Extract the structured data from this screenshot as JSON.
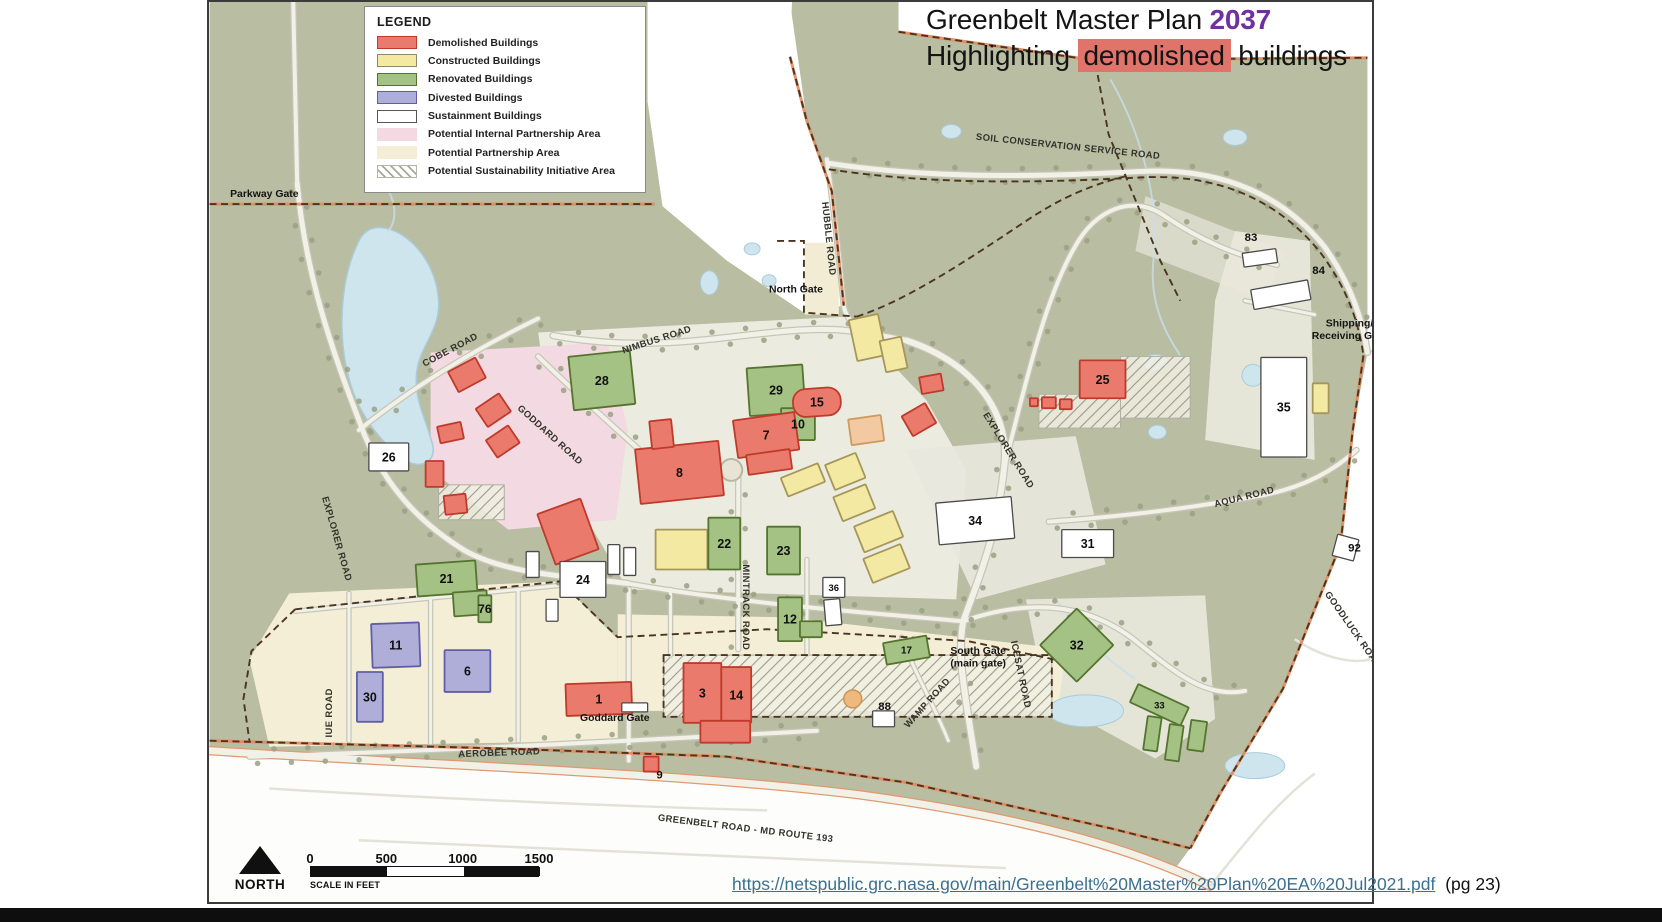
{
  "title": {
    "line1_prefix": "Greenbelt Master Plan ",
    "line1_year": "2037",
    "line2_prefix": "Highlighting ",
    "line2_highlight": "demolished",
    "line2_suffix": " buildings"
  },
  "legend": {
    "title": "LEGEND",
    "items": [
      {
        "label": "Demolished Buildings",
        "fill": "#ea7a6c",
        "stroke": "#c03a2b",
        "pattern": "solid"
      },
      {
        "label": "Constructed Buildings",
        "fill": "#f3e9a2",
        "stroke": "#8b8b6a",
        "pattern": "solid"
      },
      {
        "label": "Renovated Buildings",
        "fill": "#a3c283",
        "stroke": "#55742f",
        "pattern": "solid"
      },
      {
        "label": "Divested Buildings",
        "fill": "#afaed8",
        "stroke": "#605ea8",
        "pattern": "solid"
      },
      {
        "label": "Sustainment Buildings",
        "fill": "#ffffff",
        "stroke": "#555555",
        "pattern": "solid"
      },
      {
        "label": "Potential Internal Partnership Area",
        "fill": "#f3d9e1",
        "stroke": "none",
        "pattern": "solid"
      },
      {
        "label": "Potential Partnership Area",
        "fill": "#f5eed6",
        "stroke": "none",
        "pattern": "solid"
      },
      {
        "label": "Potential Sustainability Initiative Area",
        "fill": "",
        "stroke": "none",
        "pattern": "hatch"
      }
    ]
  },
  "scalebar": {
    "ticks": [
      "0",
      "500",
      "1000",
      "1500"
    ],
    "caption": "SCALE IN FEET",
    "north_label": "NORTH"
  },
  "footer": {
    "url": "https://netspublic.grc.nasa.gov/main/Greenbelt%20Master%20Plan%20EA%20Jul2021.pdf",
    "page_ref": "(pg 23)"
  },
  "colors": {
    "accent_year": "#7030a0",
    "highlight": "#e1746a",
    "link": "#3a7191",
    "terrain": "#b9bda1",
    "terrain_light": "#eeede4",
    "water": "#cfe5ee",
    "water_stroke": "#a9cbda",
    "pink_area": "#f3d9e1",
    "cream_area": "#f5eed6",
    "demolished": "#ea7a6c",
    "demolished_stroke": "#c03a2b",
    "constructed": "#f3e9a2",
    "constructed_stroke": "#a5975a",
    "renovated": "#a3c283",
    "renovated_stroke": "#55742f",
    "divested": "#afaed8",
    "divested_stroke": "#605ea8",
    "sustainment": "#ffffff",
    "sustainment_stroke": "#4a4a4a",
    "partnership_orange": "#f2c9a0",
    "partnership_orange_stroke": "#cf9a60",
    "boundary_black": "#4a3520",
    "boundary_orange": "#e08a5e",
    "road_fill": "#f2f1e8",
    "road_casing": "#c6c6b8",
    "greenbelt_road_casing": "#e09a70",
    "tree": "#9aa184"
  },
  "map": {
    "road_labels": [
      {
        "text": "COBE ROAD",
        "x": 243,
        "y": 352,
        "r": -28
      },
      {
        "text": "GODDARD ROAD",
        "x": 340,
        "y": 437,
        "r": 42
      },
      {
        "text": "NIMBUS ROAD",
        "x": 450,
        "y": 342,
        "r": -18
      },
      {
        "text": "EXPLORER ROAD",
        "x": 125,
        "y": 540,
        "r": 74
      },
      {
        "text": "EXPLORER ROAD",
        "x": 800,
        "y": 452,
        "r": 58
      },
      {
        "text": "MINTRACK ROAD",
        "x": 536,
        "y": 608,
        "r": 90
      },
      {
        "text": "IUE ROAD",
        "x": 123,
        "y": 714,
        "r": -90
      },
      {
        "text": "AEROBEE ROAD",
        "x": 291,
        "y": 757,
        "r": -2
      },
      {
        "text": "WAMP ROAD",
        "x": 723,
        "y": 706,
        "r": -48
      },
      {
        "text": "GREENBELT ROAD - MD ROUTE 193",
        "x": 538,
        "y": 833,
        "r": 7
      },
      {
        "text": "SOIL CONSERVATION SERVICE ROAD",
        "x": 862,
        "y": 148,
        "r": 6
      },
      {
        "text": "AQUA ROAD",
        "x": 1040,
        "y": 500,
        "r": -14
      },
      {
        "text": "GOODLUCK ROAD",
        "x": 1146,
        "y": 632,
        "r": 55
      },
      {
        "text": "HUBBLE ROAD",
        "x": 619,
        "y": 238,
        "r": 84
      },
      {
        "text": "ICESAT ROAD",
        "x": 812,
        "y": 676,
        "r": 78
      }
    ],
    "gate_labels": [
      {
        "lines": [
          "Parkway Gate"
        ],
        "x": 55,
        "y": 196
      },
      {
        "lines": [
          "North Gate"
        ],
        "x": 589,
        "y": 292
      },
      {
        "lines": [
          "Shipping/",
          "Receiving Gate"
        ],
        "x": 1145,
        "y": 326
      },
      {
        "lines": [
          "South Gate",
          "(main gate)"
        ],
        "x": 772,
        "y": 655
      },
      {
        "lines": [
          "Goddard Gate"
        ],
        "x": 407,
        "y": 722
      }
    ],
    "number_labels": [
      {
        "text": "83",
        "x": 1046,
        "y": 236
      },
      {
        "text": "84",
        "x": 1114,
        "y": 269
      },
      {
        "text": "88",
        "x": 678,
        "y": 707
      },
      {
        "text": "9",
        "x": 452,
        "y": 776
      },
      {
        "text": "92",
        "x": 1150,
        "y": 548
      }
    ],
    "buildings": [
      {
        "n": "26",
        "t": "s",
        "x": 160,
        "y": 443,
        "w": 40,
        "h": 28,
        "r": 0
      },
      {
        "n": "28",
        "t": "r",
        "x": 363,
        "y": 353,
        "w": 62,
        "h": 54,
        "r": -6
      },
      {
        "n": "29",
        "t": "r",
        "x": 541,
        "y": 366,
        "w": 56,
        "h": 48,
        "r": -4
      },
      {
        "n": "10",
        "t": "r",
        "x": 574,
        "y": 408,
        "w": 34,
        "h": 32,
        "r": 0
      },
      {
        "n": "7",
        "t": "d",
        "x": 528,
        "y": 416,
        "w": 62,
        "h": 38,
        "r": -8
      },
      {
        "n": "",
        "t": "d",
        "x": 540,
        "y": 452,
        "w": 44,
        "h": 20,
        "r": -8
      },
      {
        "n": "8",
        "t": "d",
        "x": 430,
        "y": 445,
        "w": 84,
        "h": 55,
        "r": -6
      },
      {
        "n": "",
        "t": "d",
        "x": 443,
        "y": 420,
        "w": 22,
        "h": 28,
        "r": -6
      },
      {
        "n": "",
        "t": "d",
        "x": 337,
        "y": 505,
        "w": 46,
        "h": 54,
        "r": -20
      },
      {
        "n": "15",
        "t": "d",
        "x": 586,
        "y": 388,
        "w": 48,
        "h": 28,
        "r": -4,
        "blob": true
      },
      {
        "n": "",
        "t": "d",
        "x": 714,
        "y": 375,
        "w": 22,
        "h": 17,
        "r": -10
      },
      {
        "n": "",
        "t": "d",
        "x": 699,
        "y": 408,
        "w": 27,
        "h": 23,
        "r": -30
      },
      {
        "n": "",
        "t": "d",
        "x": 243,
        "y": 363,
        "w": 31,
        "h": 23,
        "r": -28
      },
      {
        "n": "",
        "t": "d",
        "x": 271,
        "y": 399,
        "w": 28,
        "h": 22,
        "r": -34
      },
      {
        "n": "",
        "t": "d",
        "x": 230,
        "y": 424,
        "w": 24,
        "h": 17,
        "r": -12
      },
      {
        "n": "",
        "t": "d",
        "x": 281,
        "y": 431,
        "w": 27,
        "h": 21,
        "r": -34
      },
      {
        "n": "",
        "t": "d",
        "x": 217,
        "y": 461,
        "w": 18,
        "h": 26,
        "r": 0
      },
      {
        "n": "",
        "t": "d",
        "x": 236,
        "y": 495,
        "w": 22,
        "h": 19,
        "r": -6
      },
      {
        "n": "25",
        "t": "d",
        "x": 874,
        "y": 360,
        "w": 46,
        "h": 38,
        "r": 0
      },
      {
        "n": "",
        "t": "d",
        "x": 836,
        "y": 397,
        "w": 14,
        "h": 11,
        "r": 0
      },
      {
        "n": "",
        "t": "d",
        "x": 854,
        "y": 399,
        "w": 12,
        "h": 10,
        "r": 0
      },
      {
        "n": "",
        "t": "d",
        "x": 824,
        "y": 398,
        "w": 8,
        "h": 8,
        "r": 0
      },
      {
        "n": "1",
        "t": "d",
        "x": 358,
        "y": 684,
        "w": 66,
        "h": 32,
        "r": -2
      },
      {
        "n": "3",
        "t": "d",
        "x": 476,
        "y": 664,
        "w": 38,
        "h": 60,
        "r": 0
      },
      {
        "n": "14",
        "t": "d",
        "x": 514,
        "y": 668,
        "w": 30,
        "h": 56,
        "r": 0
      },
      {
        "n": "",
        "t": "d",
        "x": 493,
        "y": 722,
        "w": 50,
        "h": 22,
        "r": 0
      },
      {
        "n": "",
        "t": "d",
        "x": 436,
        "y": 758,
        "w": 15,
        "h": 15,
        "r": 0
      },
      {
        "n": "",
        "t": "c",
        "x": 646,
        "y": 316,
        "w": 30,
        "h": 42,
        "r": -12
      },
      {
        "n": "",
        "t": "c",
        "x": 676,
        "y": 338,
        "w": 22,
        "h": 32,
        "r": -12
      },
      {
        "n": "",
        "t": "c",
        "x": 448,
        "y": 530,
        "w": 52,
        "h": 40,
        "r": 0
      },
      {
        "n": "",
        "t": "c",
        "x": 576,
        "y": 470,
        "w": 40,
        "h": 20,
        "r": -22
      },
      {
        "n": "",
        "t": "c",
        "x": 622,
        "y": 458,
        "w": 33,
        "h": 27,
        "r": -22
      },
      {
        "n": "",
        "t": "c",
        "x": 630,
        "y": 490,
        "w": 35,
        "h": 26,
        "r": -22
      },
      {
        "n": "",
        "t": "c",
        "x": 651,
        "y": 518,
        "w": 42,
        "h": 28,
        "r": -22
      },
      {
        "n": "",
        "t": "c",
        "x": 660,
        "y": 551,
        "w": 40,
        "h": 26,
        "r": -22
      },
      {
        "n": "",
        "t": "c",
        "x": 1108,
        "y": 383,
        "w": 16,
        "h": 30,
        "r": 0
      },
      {
        "n": "",
        "t": "o",
        "x": 643,
        "y": 417,
        "w": 33,
        "h": 26,
        "r": -8
      },
      {
        "n": "21",
        "t": "r",
        "x": 208,
        "y": 563,
        "w": 60,
        "h": 32,
        "r": -4
      },
      {
        "n": "",
        "t": "r",
        "x": 245,
        "y": 592,
        "w": 34,
        "h": 24,
        "r": -4
      },
      {
        "n": "22",
        "t": "r",
        "x": 501,
        "y": 518,
        "w": 32,
        "h": 52,
        "r": 0
      },
      {
        "n": "23",
        "t": "r",
        "x": 560,
        "y": 527,
        "w": 33,
        "h": 48,
        "r": 0
      },
      {
        "n": "12",
        "t": "r",
        "x": 571,
        "y": 598,
        "w": 24,
        "h": 44,
        "r": 0
      },
      {
        "n": "",
        "t": "r",
        "x": 593,
        "y": 622,
        "w": 22,
        "h": 16,
        "r": 0
      },
      {
        "n": "17",
        "t": "r",
        "x": 678,
        "y": 640,
        "w": 44,
        "h": 22,
        "r": -10
      },
      {
        "n": "32",
        "t": "r",
        "x": 845,
        "y": 620,
        "w": 52,
        "h": 52,
        "r": 45
      },
      {
        "n": "33",
        "t": "r",
        "x": 926,
        "y": 696,
        "w": 56,
        "h": 20,
        "r": 25
      },
      {
        "n": "",
        "t": "r",
        "x": 940,
        "y": 718,
        "w": 14,
        "h": 34,
        "r": 8
      },
      {
        "n": "",
        "t": "r",
        "x": 962,
        "y": 726,
        "w": 14,
        "h": 36,
        "r": 8
      },
      {
        "n": "",
        "t": "r",
        "x": 984,
        "y": 722,
        "w": 16,
        "h": 30,
        "r": 8
      },
      {
        "n": "76",
        "t": "r",
        "x": 270,
        "y": 596,
        "w": 13,
        "h": 27,
        "r": 0
      },
      {
        "n": "11",
        "t": "v",
        "x": 163,
        "y": 624,
        "w": 48,
        "h": 44,
        "r": -2
      },
      {
        "n": "30",
        "t": "v",
        "x": 148,
        "y": 673,
        "w": 26,
        "h": 50,
        "r": 0
      },
      {
        "n": "6",
        "t": "v",
        "x": 236,
        "y": 651,
        "w": 46,
        "h": 42,
        "r": 0
      },
      {
        "n": "24",
        "t": "s",
        "x": 352,
        "y": 562,
        "w": 46,
        "h": 36,
        "r": 0
      },
      {
        "n": "",
        "t": "s",
        "x": 400,
        "y": 545,
        "w": 12,
        "h": 30,
        "r": 0
      },
      {
        "n": "",
        "t": "s",
        "x": 416,
        "y": 548,
        "w": 12,
        "h": 28,
        "r": 0
      },
      {
        "n": "",
        "t": "s",
        "x": 318,
        "y": 552,
        "w": 13,
        "h": 26,
        "r": 0
      },
      {
        "n": "",
        "t": "s",
        "x": 338,
        "y": 600,
        "w": 12,
        "h": 22,
        "r": 0
      },
      {
        "n": "36",
        "t": "s",
        "x": 616,
        "y": 578,
        "w": 22,
        "h": 20,
        "r": 0
      },
      {
        "n": "",
        "t": "s",
        "x": 618,
        "y": 600,
        "w": 16,
        "h": 26,
        "r": -5
      },
      {
        "n": "34",
        "t": "s",
        "x": 731,
        "y": 500,
        "w": 76,
        "h": 42,
        "r": -5
      },
      {
        "n": "31",
        "t": "s",
        "x": 856,
        "y": 530,
        "w": 52,
        "h": 28,
        "r": 0
      },
      {
        "n": "35",
        "t": "s",
        "x": 1056,
        "y": 357,
        "w": 46,
        "h": 100,
        "r": 0
      },
      {
        "n": "",
        "t": "s",
        "x": 1038,
        "y": 250,
        "w": 34,
        "h": 14,
        "r": -8
      },
      {
        "n": "",
        "t": "s",
        "x": 1047,
        "y": 284,
        "w": 58,
        "h": 20,
        "r": -10
      },
      {
        "n": "",
        "t": "s",
        "x": 1130,
        "y": 537,
        "w": 22,
        "h": 22,
        "r": 15
      },
      {
        "n": "",
        "t": "s",
        "x": 666,
        "y": 712,
        "w": 22,
        "h": 16,
        "r": 0
      },
      {
        "n": "",
        "t": "s",
        "x": 414,
        "y": 704,
        "w": 26,
        "h": 9,
        "r": 0
      }
    ]
  }
}
